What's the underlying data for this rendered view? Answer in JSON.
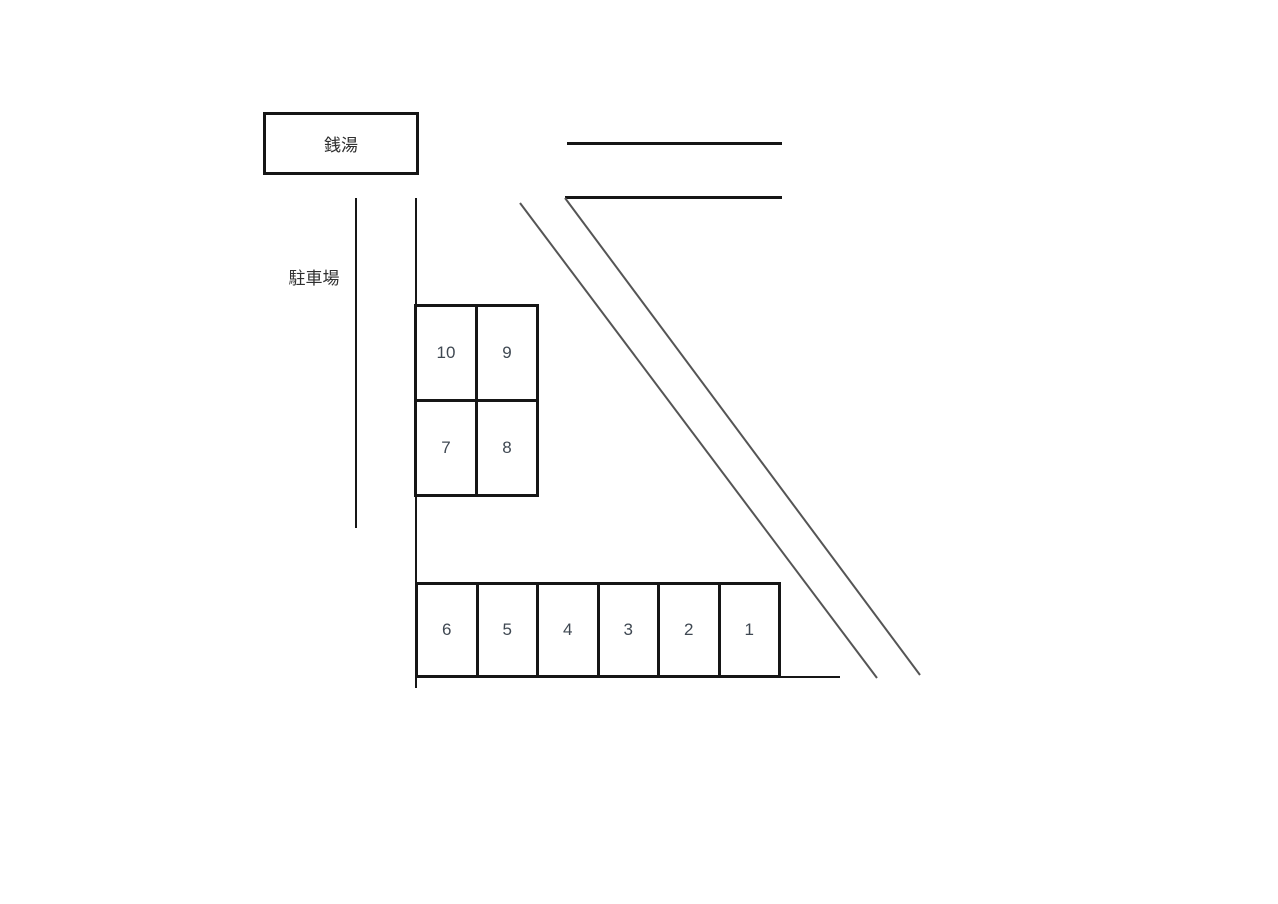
{
  "labels": {
    "building": "銭湯",
    "area": "駐車場"
  },
  "upper_lot": {
    "cells": [
      "10",
      "9",
      "7",
      "8"
    ]
  },
  "lower_lot": {
    "cells": [
      "6",
      "5",
      "4",
      "3",
      "2",
      "1"
    ]
  },
  "colors": {
    "background": "#ffffff",
    "outline": "#161616",
    "road_line": "#555555",
    "number_text": "#3f4852",
    "label_text": "#2f2f2f"
  }
}
